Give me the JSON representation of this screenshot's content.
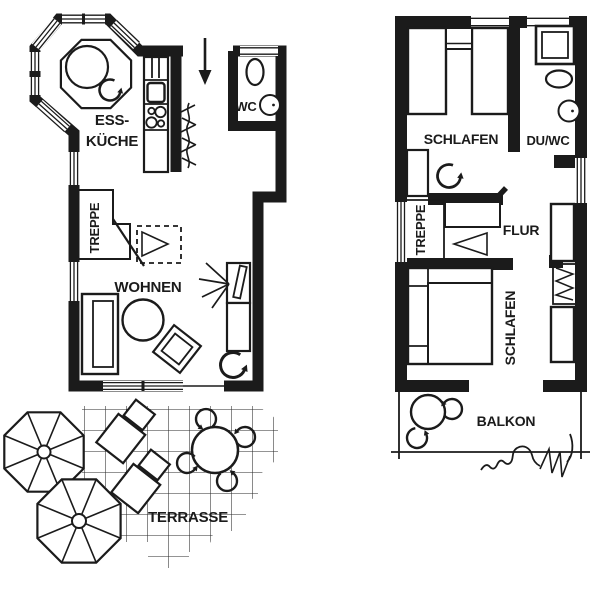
{
  "colors": {
    "ink": "#1b1b1b",
    "background": "#ffffff"
  },
  "ground_floor": {
    "labels": {
      "kitchen_line1": "ESS-",
      "kitchen_line2": "KÜCHE",
      "wc": "WC",
      "stairs": "TREPPE",
      "living": "WOHNEN",
      "terrace": "TERRASSE"
    }
  },
  "upper_floor": {
    "labels": {
      "bedroom_front": "SCHLAFEN",
      "shower_wc": "DU/WC",
      "stairs": "TREPPE",
      "hallway": "FLUR",
      "bedroom_rear": "SCHLAFEN",
      "balcony": "BALKON"
    }
  }
}
